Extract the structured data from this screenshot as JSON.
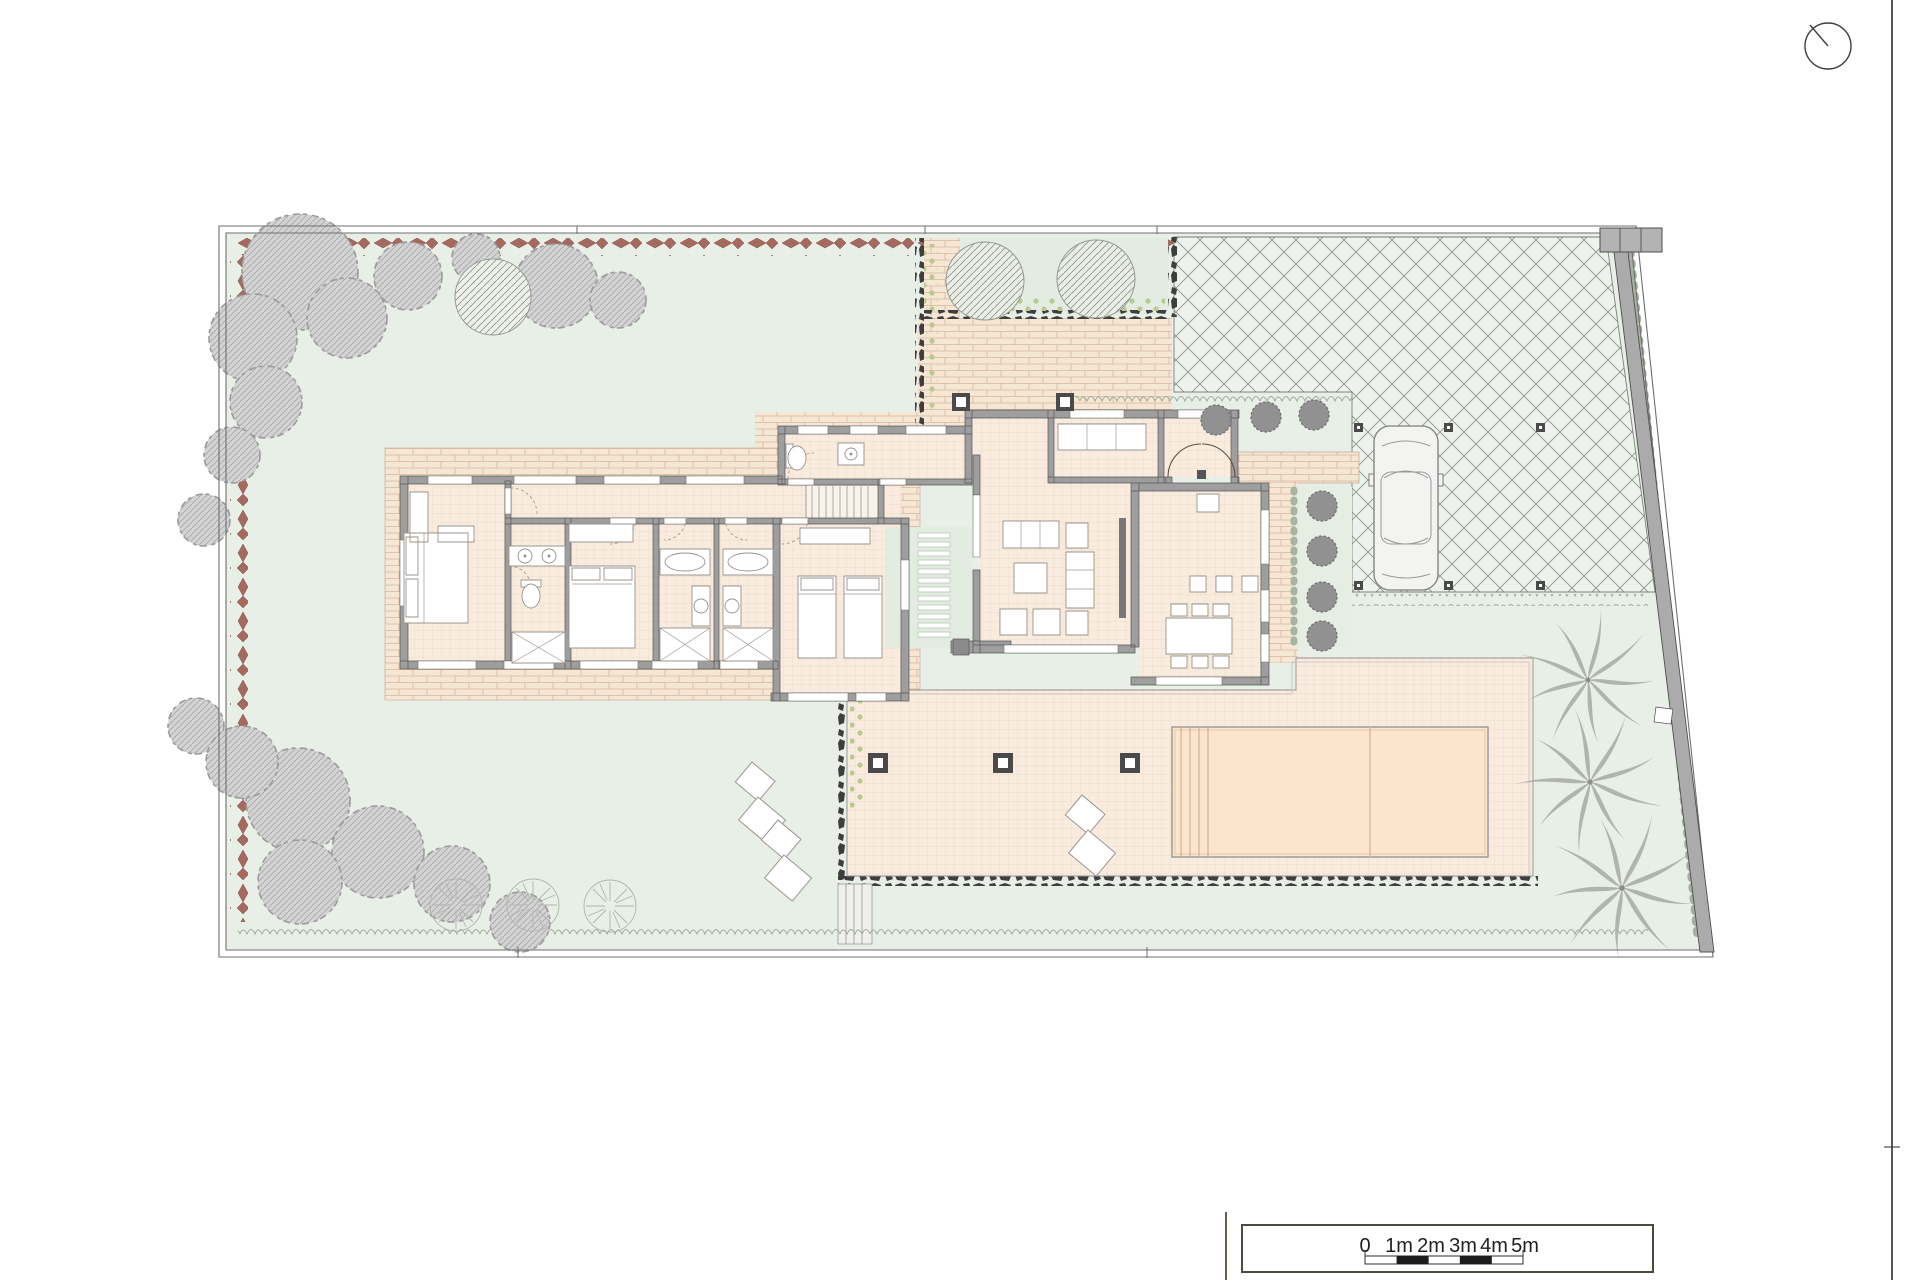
{
  "drawing": {
    "kind": "site-and-floor-plan",
    "north_indicator_icon": "north-arrow-circle-icon",
    "areas": [
      "garden-lawn",
      "bedroom-1",
      "ensuite-bathroom",
      "bedroom-2",
      "bathroom-1",
      "bathroom-2",
      "bedroom-3",
      "wc",
      "staircase",
      "inner-courtyard",
      "living-room",
      "entrance-hall",
      "study",
      "entrance-vestibule",
      "kitchen-dining-room",
      "rear-terrace",
      "walled-garden-patch",
      "entry-path",
      "south-terrace",
      "swimming-pool",
      "pool-steps",
      "driveway",
      "parking-bay",
      "car",
      "palm-trees",
      "boundary-hedge",
      "perimeter-wall",
      "entrance-gate"
    ]
  },
  "scale_bar": {
    "labels": [
      "0",
      "1m",
      "2m",
      "3m",
      "4m",
      "5m"
    ]
  },
  "palette": {
    "paper": "#ffffff",
    "lawn": "#e8efe6",
    "interior_tile": "#f9ecdf",
    "brick_paving": "#f6e6d4",
    "pool_water": "#fbe5cc",
    "walls": "#9e9e9e",
    "driveway_bg": "#edf2ec",
    "driveway_hatch": "#8d958b",
    "hedge_red": "#a4695f",
    "planting_gray": "#bdbdbd",
    "shrub_green": "#b7ca92",
    "courtyard_green": "#e3ece0",
    "stone_border": "#3e3e3e"
  }
}
